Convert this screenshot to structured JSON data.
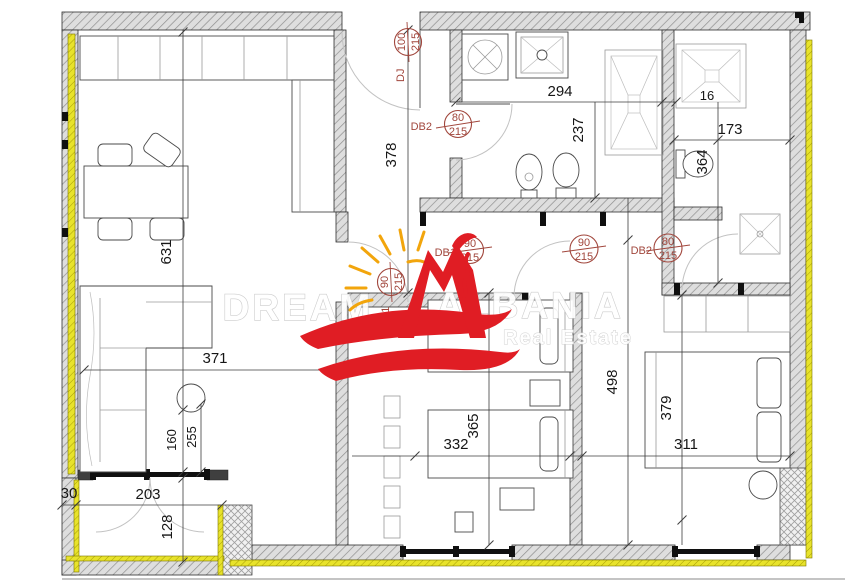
{
  "watermark": {
    "word1": "DREAM",
    "word2": "ALBANIA",
    "subtitle": "Real Estate"
  },
  "dimensions": {
    "kitchen_depth": "631",
    "entry_depth": "378",
    "bath_width": "294",
    "wall_gap": "16",
    "bath_depth": "237",
    "wc_width": "173",
    "wc_depth": "364",
    "living_width": "371",
    "window_width": "160",
    "window_height": "255",
    "balcony_side": "30",
    "balcony_width": "203",
    "balcony_depth": "128",
    "bedroom2_width": "332",
    "bedroom2_depth": "365",
    "bedroom1_depth": "498",
    "bed_length": "379",
    "bedroom1_width": "311"
  },
  "doors": {
    "entry": {
      "code": "DJ",
      "width": "100",
      "height": "215"
    },
    "bathroom": {
      "code": "DB2",
      "width": "80",
      "height": "215"
    },
    "living": {
      "code": "DB1",
      "width": "90",
      "height": "215"
    },
    "living_side": {
      "code": "DB1",
      "width": "90",
      "height": "215"
    },
    "bedroom2": {
      "width": "90",
      "height": "215"
    },
    "bedroom1": {
      "code": "DB2",
      "width": "80",
      "height": "215"
    }
  },
  "colors": {
    "insulation_yellow": "#e8e32b",
    "door_label_red": "#a1463c",
    "logo_red": "#e01d24",
    "sun_orange": "#f2a50c"
  }
}
